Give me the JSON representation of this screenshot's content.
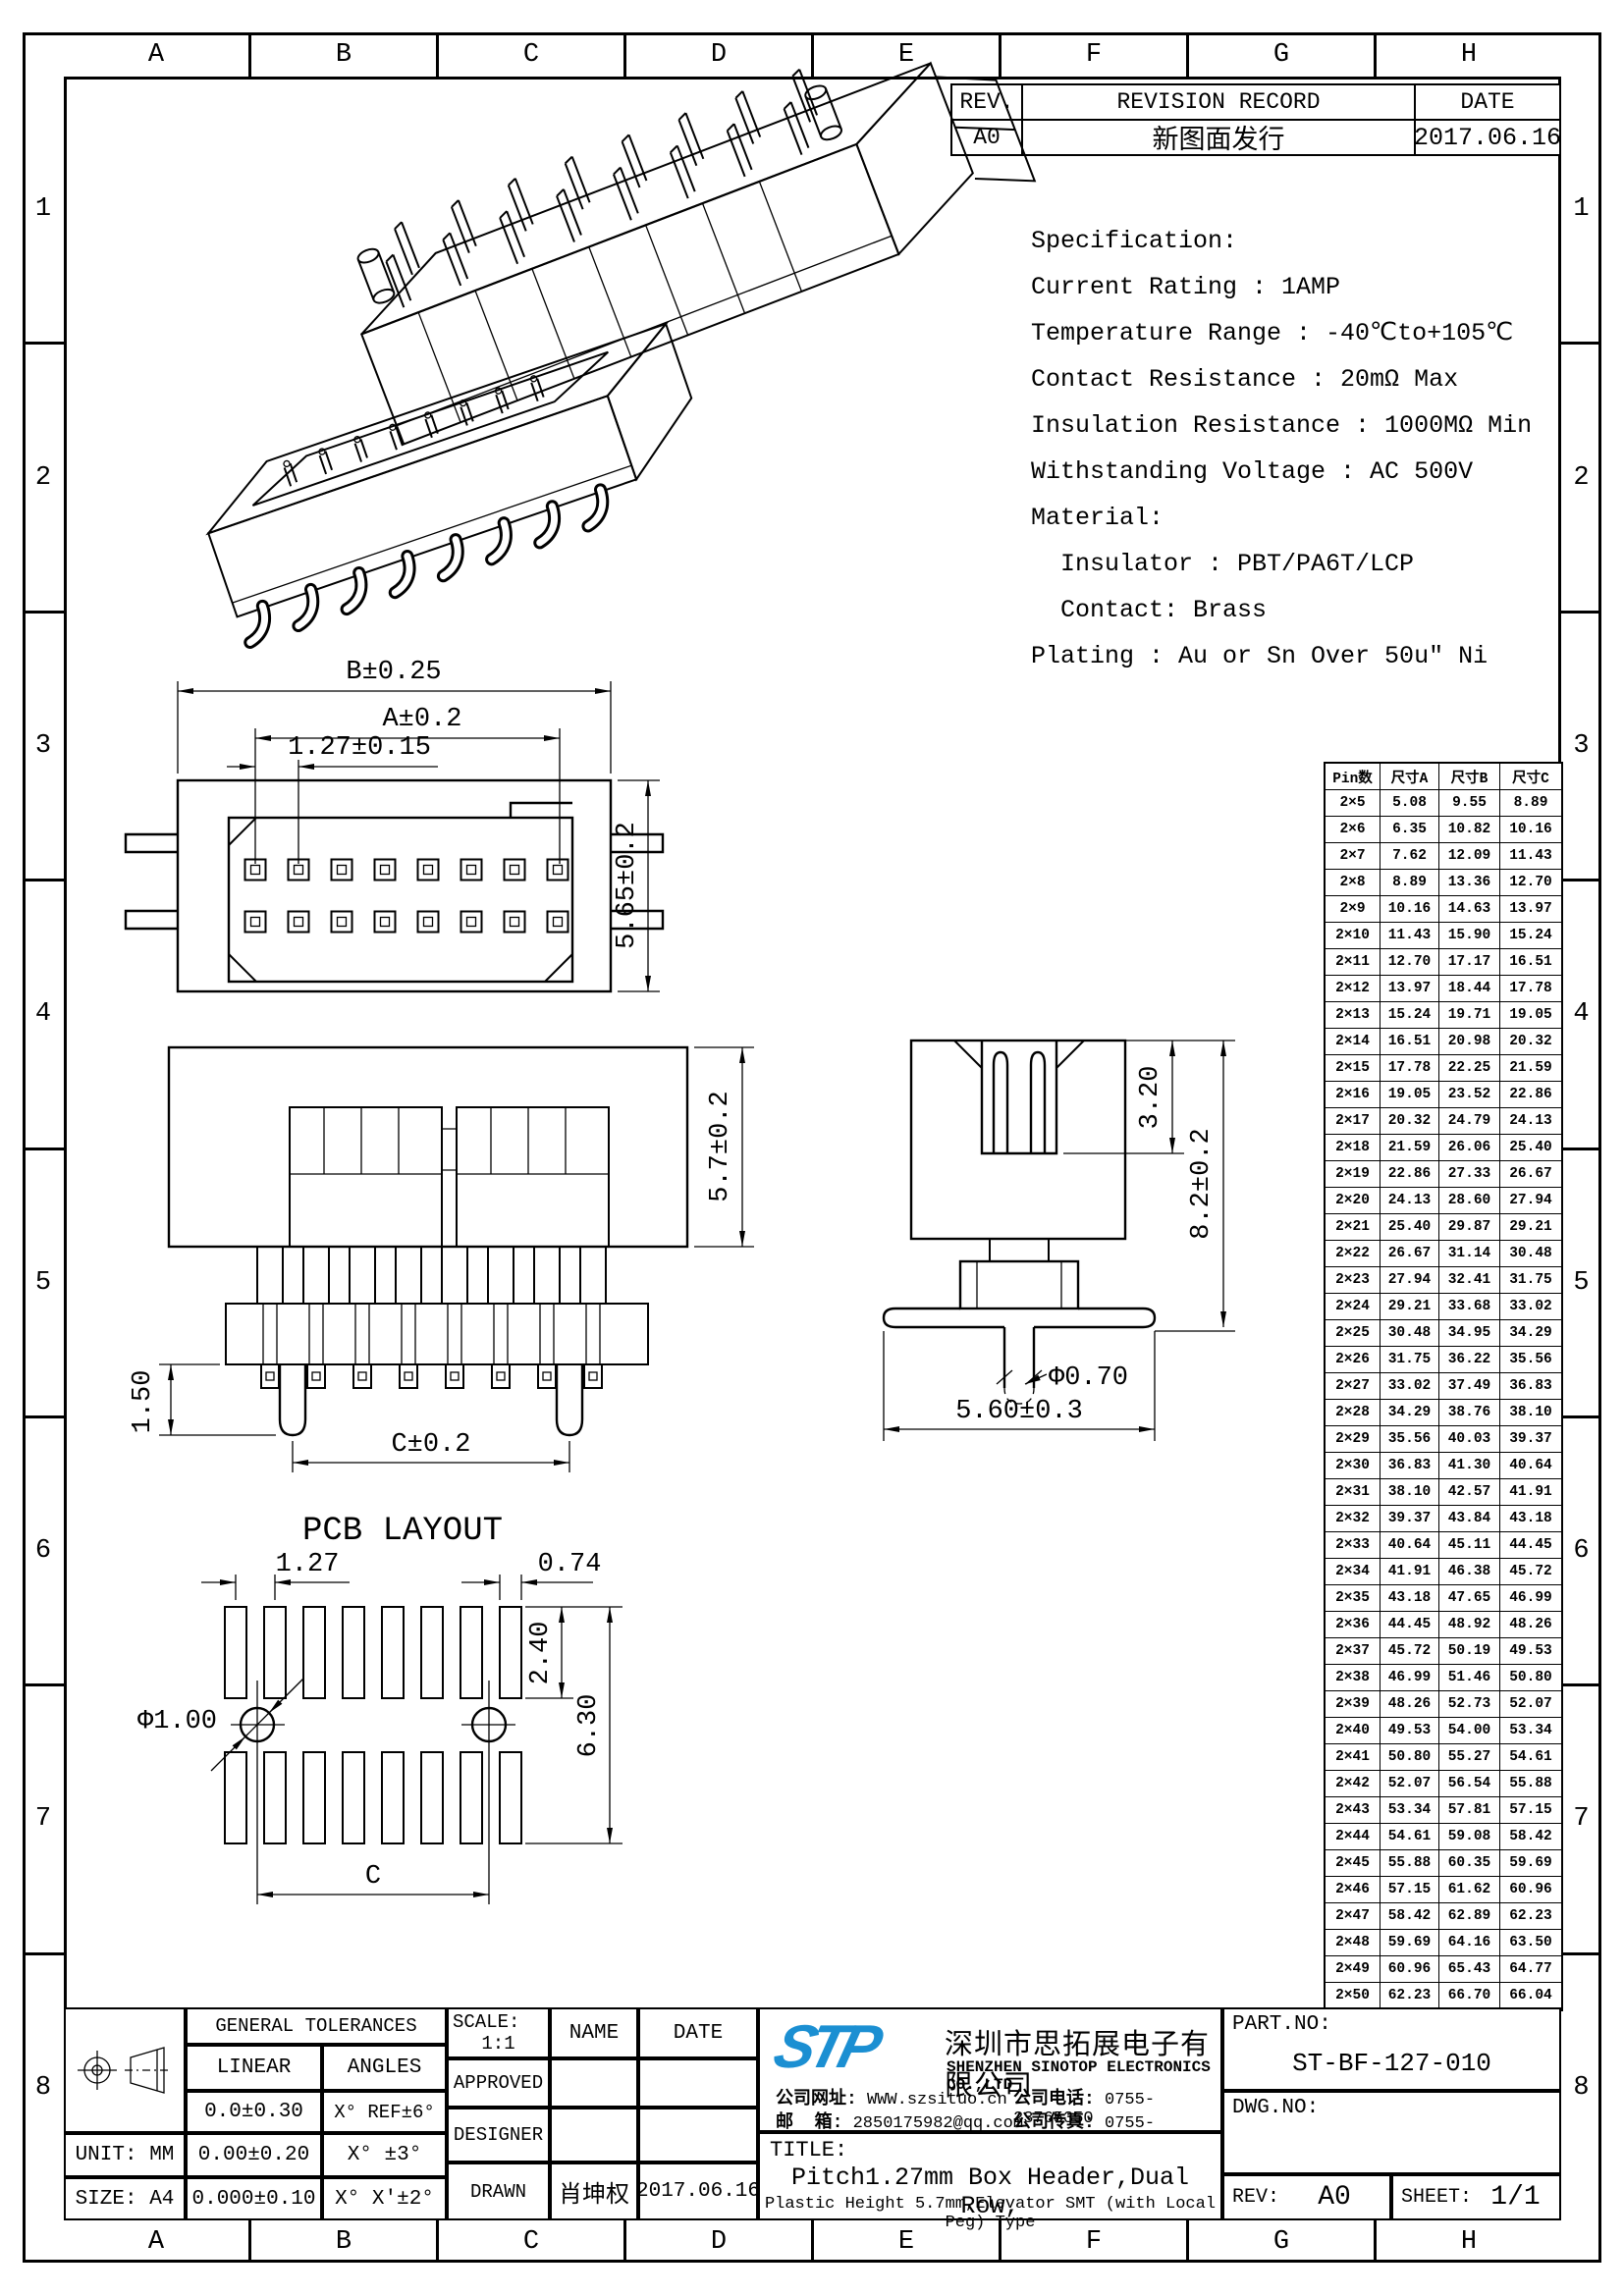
{
  "colors": {
    "line": "#000000",
    "background": "#ffffff",
    "logo_blue": "#1b8fd2"
  },
  "sheet": {
    "grid_columns": [
      "A",
      "B",
      "C",
      "D",
      "E",
      "F",
      "G",
      "H"
    ],
    "grid_rows": [
      "1",
      "2",
      "3",
      "4",
      "5",
      "6",
      "7",
      "8"
    ]
  },
  "revision_table": {
    "rev_header": "REV.",
    "record_header": "REVISION RECORD",
    "date_header": "DATE",
    "rows": [
      {
        "rev": "A0",
        "record": "新图面发行",
        "date": "2017.06.16"
      }
    ]
  },
  "specification": {
    "lines": [
      "Specification:",
      "Current Rating : 1AMP",
      "Temperature Range : -40℃to+105℃",
      "Contact Resistance : 20mΩ Max",
      "Insulation Resistance : 1000MΩ Min",
      "Withstanding Voltage : AC 500V",
      "Material:",
      "  Insulator : PBT/PA6T/LCP",
      "  Contact: Brass",
      "Plating : Au or Sn Over 50u″ Ni"
    ]
  },
  "dimension_table": {
    "headers": [
      "Pin数",
      "尺寸A",
      "尺寸B",
      "尺寸C"
    ],
    "rows": [
      [
        "2×5",
        "5.08",
        "9.55",
        "8.89"
      ],
      [
        "2×6",
        "6.35",
        "10.82",
        "10.16"
      ],
      [
        "2×7",
        "7.62",
        "12.09",
        "11.43"
      ],
      [
        "2×8",
        "8.89",
        "13.36",
        "12.70"
      ],
      [
        "2×9",
        "10.16",
        "14.63",
        "13.97"
      ],
      [
        "2×10",
        "11.43",
        "15.90",
        "15.24"
      ],
      [
        "2×11",
        "12.70",
        "17.17",
        "16.51"
      ],
      [
        "2×12",
        "13.97",
        "18.44",
        "17.78"
      ],
      [
        "2×13",
        "15.24",
        "19.71",
        "19.05"
      ],
      [
        "2×14",
        "16.51",
        "20.98",
        "20.32"
      ],
      [
        "2×15",
        "17.78",
        "22.25",
        "21.59"
      ],
      [
        "2×16",
        "19.05",
        "23.52",
        "22.86"
      ],
      [
        "2×17",
        "20.32",
        "24.79",
        "24.13"
      ],
      [
        "2×18",
        "21.59",
        "26.06",
        "25.40"
      ],
      [
        "2×19",
        "22.86",
        "27.33",
        "26.67"
      ],
      [
        "2×20",
        "24.13",
        "28.60",
        "27.94"
      ],
      [
        "2×21",
        "25.40",
        "29.87",
        "29.21"
      ],
      [
        "2×22",
        "26.67",
        "31.14",
        "30.48"
      ],
      [
        "2×23",
        "27.94",
        "32.41",
        "31.75"
      ],
      [
        "2×24",
        "29.21",
        "33.68",
        "33.02"
      ],
      [
        "2×25",
        "30.48",
        "34.95",
        "34.29"
      ],
      [
        "2×26",
        "31.75",
        "36.22",
        "35.56"
      ],
      [
        "2×27",
        "33.02",
        "37.49",
        "36.83"
      ],
      [
        "2×28",
        "34.29",
        "38.76",
        "38.10"
      ],
      [
        "2×29",
        "35.56",
        "40.03",
        "39.37"
      ],
      [
        "2×30",
        "36.83",
        "41.30",
        "40.64"
      ],
      [
        "2×31",
        "38.10",
        "42.57",
        "41.91"
      ],
      [
        "2×32",
        "39.37",
        "43.84",
        "43.18"
      ],
      [
        "2×33",
        "40.64",
        "45.11",
        "44.45"
      ],
      [
        "2×34",
        "41.91",
        "46.38",
        "45.72"
      ],
      [
        "2×35",
        "43.18",
        "47.65",
        "46.99"
      ],
      [
        "2×36",
        "44.45",
        "48.92",
        "48.26"
      ],
      [
        "2×37",
        "45.72",
        "50.19",
        "49.53"
      ],
      [
        "2×38",
        "46.99",
        "51.46",
        "50.80"
      ],
      [
        "2×39",
        "48.26",
        "52.73",
        "52.07"
      ],
      [
        "2×40",
        "49.53",
        "54.00",
        "53.34"
      ],
      [
        "2×41",
        "50.80",
        "55.27",
        "54.61"
      ],
      [
        "2×42",
        "52.07",
        "56.54",
        "55.88"
      ],
      [
        "2×43",
        "53.34",
        "57.81",
        "57.15"
      ],
      [
        "2×44",
        "54.61",
        "59.08",
        "58.42"
      ],
      [
        "2×45",
        "55.88",
        "60.35",
        "59.69"
      ],
      [
        "2×46",
        "57.15",
        "61.62",
        "60.96"
      ],
      [
        "2×47",
        "58.42",
        "62.89",
        "62.23"
      ],
      [
        "2×48",
        "59.69",
        "64.16",
        "63.50"
      ],
      [
        "2×49",
        "60.96",
        "65.43",
        "64.77"
      ],
      [
        "2×50",
        "62.23",
        "66.70",
        "66.04"
      ]
    ]
  },
  "views": {
    "plan": {
      "dim_overall_width": "B±0.25",
      "dim_pin_span": "A±0.2",
      "dim_pitch": "1.27±0.15",
      "dim_body_height": "5.65±0.2"
    },
    "front": {
      "dim_insulator_height": "5.7±0.2",
      "dim_peg_length": "1.50",
      "dim_peg_span": "C±0.2"
    },
    "side": {
      "dim_slot_depth": "3.20",
      "dim_overall_height": "8.2±0.2",
      "dim_peg_diameter": "Φ0.70",
      "dim_flange_width": "5.60±0.3"
    },
    "pcb_layout": {
      "title": "PCB LAYOUT",
      "dim_pad_pitch": "1.27",
      "dim_pad_width": "0.74",
      "dim_pad_length": "2.40",
      "dim_row_span": "6.30",
      "dim_hole_diameter": "Φ1.00",
      "dim_hole_span": "C"
    }
  },
  "title_block": {
    "tolerances": {
      "header": "GENERAL TOLERANCES",
      "linear_label": "LINEAR",
      "angles_label": "ANGLES",
      "linear_rows": [
        "0.0±0.30",
        "0.00±0.20",
        "0.000±0.10"
      ],
      "angle_rows": [
        "X° REF±6°",
        "X° ±3°",
        "X° X'±2°"
      ],
      "unit": "UNIT: MM",
      "size": "SIZE: A4"
    },
    "approval": {
      "scale_label": "SCALE:",
      "scale_value": "1:1",
      "name_header": "NAME",
      "date_header": "DATE",
      "approved_label": "APPROVED",
      "designer_label": "DESIGNER",
      "drawn_label": "DRAWN",
      "drawn_name": "肖坤权",
      "drawn_date": "2017.06.16"
    },
    "company": {
      "logo_text": "STP",
      "name_cn": "深圳市思拓展电子有限公司",
      "name_en": "SHENZHEN SINOTOP ELECTRONICS CO.,LTD",
      "website_label": "公司网址:",
      "website": "WWW.szsituo.cn",
      "email_label": "邮  箱:",
      "email": "2850175982@qq.com",
      "phone_label": "公司电话:",
      "phone": "0755-23765350",
      "fax_label": "公司传真:",
      "fax": "0755-23765341"
    },
    "title": {
      "label": "TITLE:",
      "line1": "Pitch1.27mm Box Header,Dual Row,",
      "line2": "Plastic Height 5.7mm,Elevator SMT (with Local Peg) Type"
    },
    "part_no": {
      "label": "PART.NO:",
      "value": "ST-BF-127-010"
    },
    "dwg_no": {
      "label": "DWG.NO:",
      "value": ""
    },
    "rev": {
      "label": "REV:",
      "value": "A0"
    },
    "sheet_no": {
      "label": "SHEET:",
      "value": "1/1"
    }
  }
}
